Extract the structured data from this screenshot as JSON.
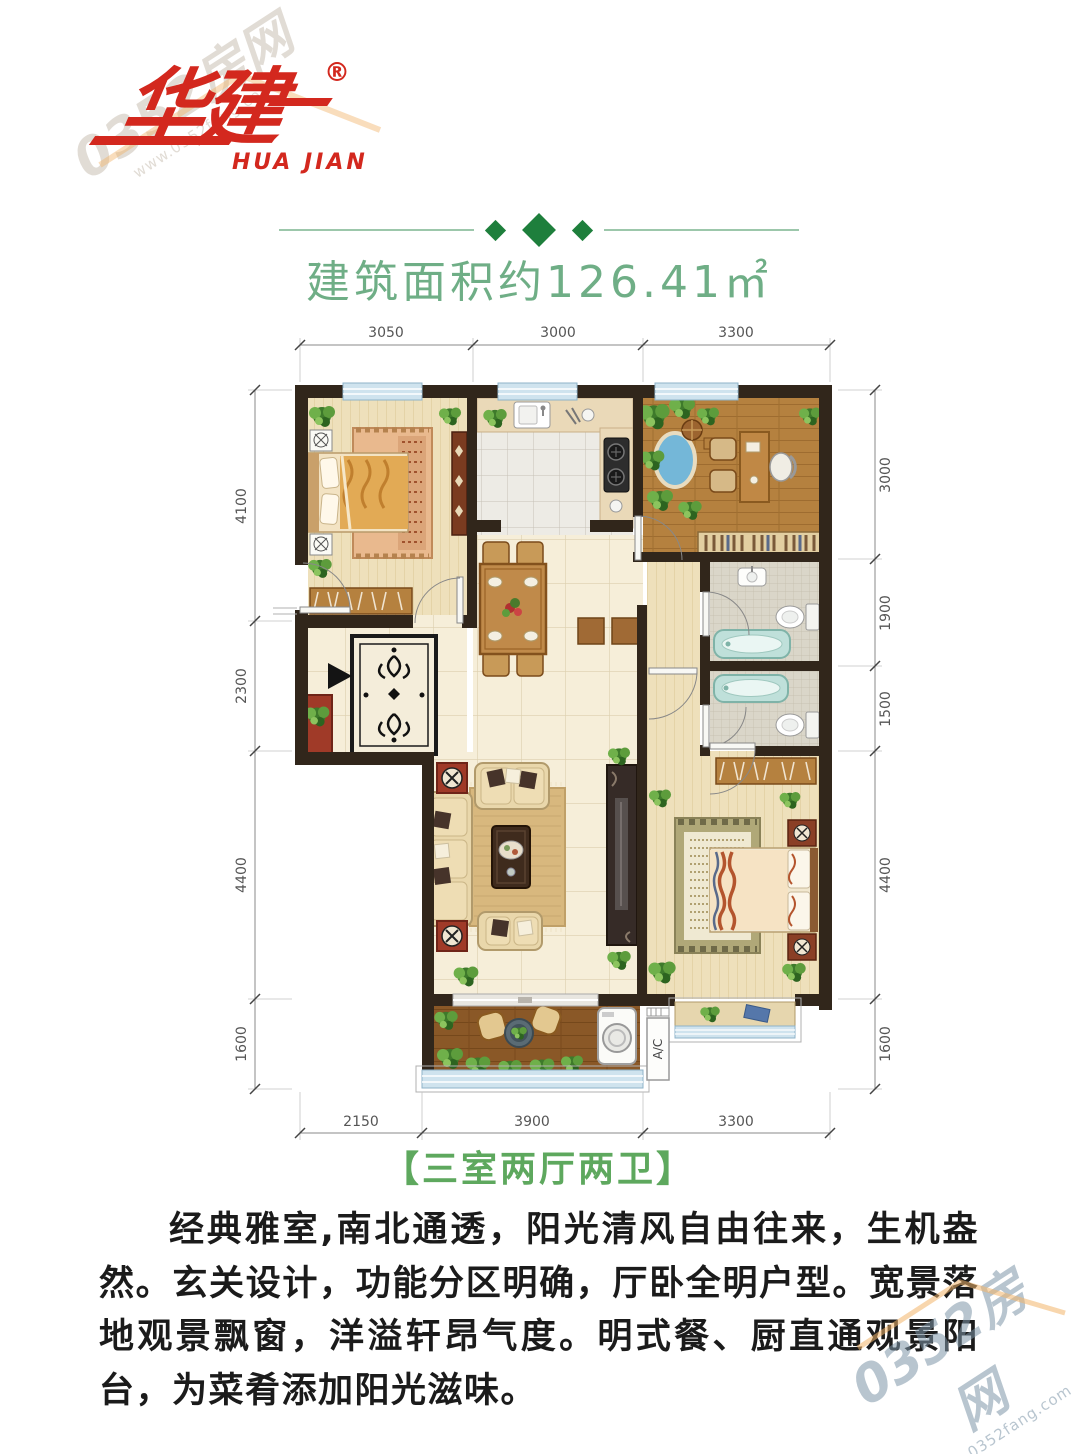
{
  "logo": {
    "cn": "华建",
    "en": "HUA JIAN",
    "reg": "®"
  },
  "header": {
    "area_title": "建筑面积约126.41㎡"
  },
  "plan": {
    "dims": {
      "top": [
        "3050",
        "3000",
        "3300"
      ],
      "bottom": [
        "2150",
        "3900",
        "3300"
      ],
      "left": [
        "4100",
        "2300",
        "4400",
        "1600"
      ],
      "right": [
        "3000",
        "1900",
        "1500",
        "4400",
        "1600"
      ]
    },
    "ac_label": "A/C"
  },
  "tag": "【三室两厅两卫】",
  "description": "经典雅室,南北通透，阳光清风自由往来，生机盎然。玄关设计，功能分区明确，厅卧全明户型。宽景落地观景飘窗，洋溢轩昂气度。明式餐、厨直通观景阳台，为菜肴添加阳光滋味。",
  "watermark": {
    "site": "0352房网",
    "url": "www.0352fang.com"
  },
  "colors": {
    "brand_red": "#d3281e",
    "title_green": "#6FAE86",
    "diamond_green": "#1E7F3C",
    "tag_green": "#5ea85e",
    "wall": "#31261b",
    "window_blue": "#cfe3ee"
  }
}
